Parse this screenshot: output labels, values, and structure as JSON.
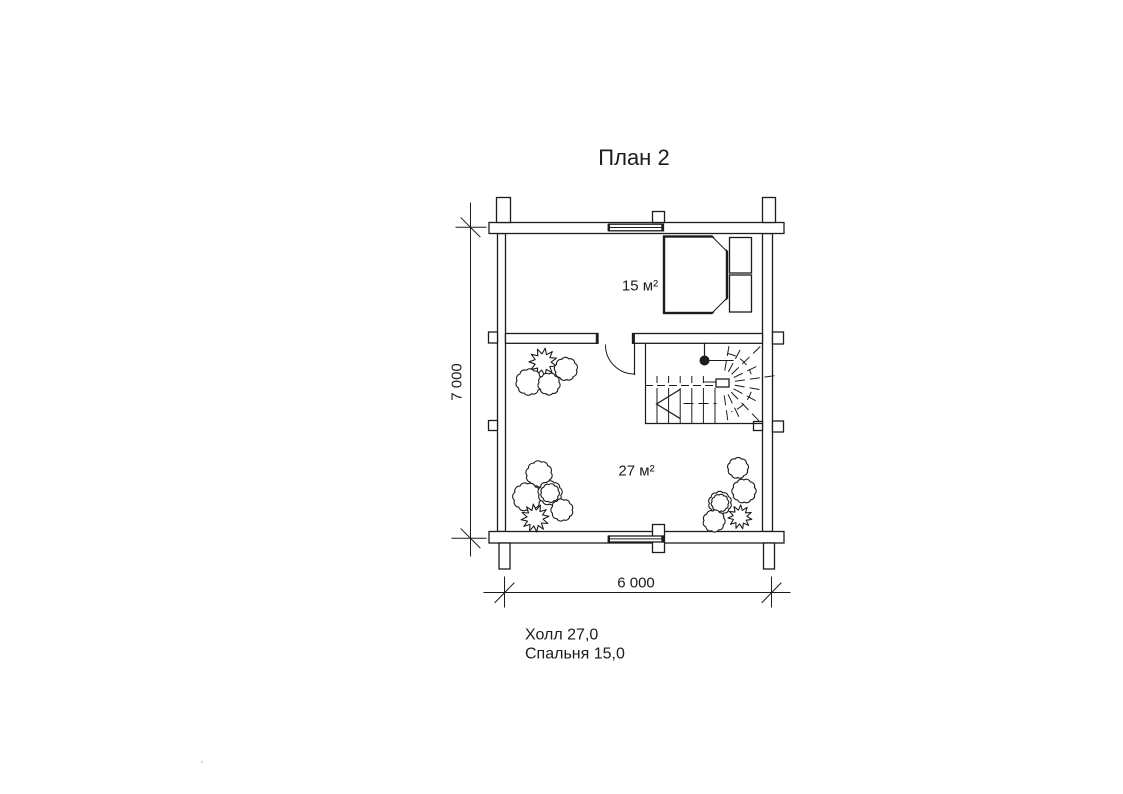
{
  "title": "План 2",
  "rooms": {
    "bedroom": {
      "area_label": "15 м²"
    },
    "hall": {
      "area_label": "27 м²"
    }
  },
  "dimensions": {
    "horizontal": "6 000",
    "vertical": "7 000"
  },
  "legend": {
    "hall": "Холл 27,0",
    "bedroom": "Спальня 15,0"
  },
  "colors": {
    "line": "#1c1c1c",
    "background": "#ffffff"
  }
}
